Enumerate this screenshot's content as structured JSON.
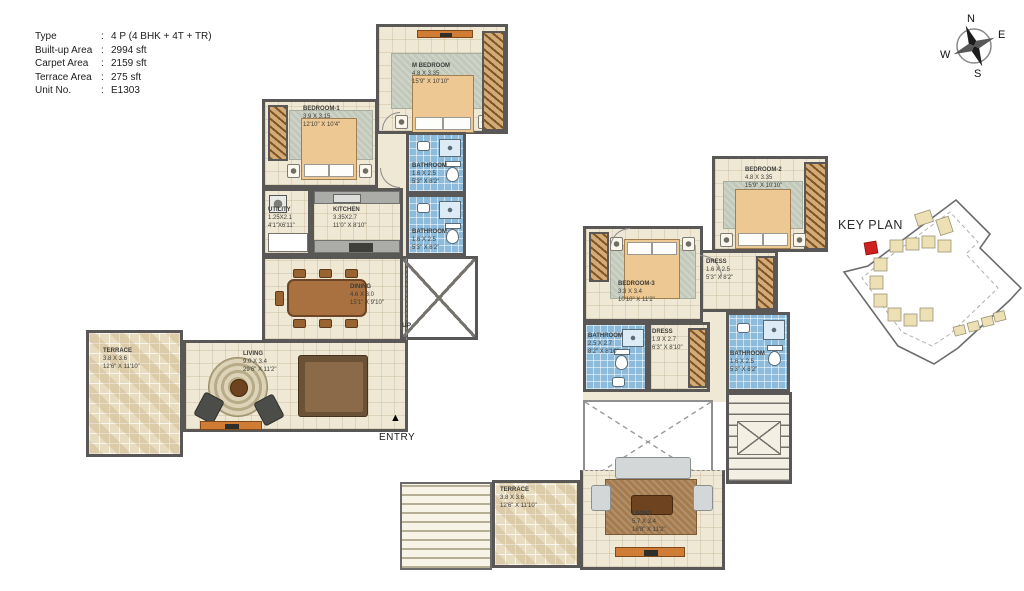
{
  "info_panel": {
    "separator": ":",
    "rows": [
      {
        "label": "Type",
        "value": "4 P (4 BHK + 4T + TR)"
      },
      {
        "label": "Built-up Area",
        "value": "2994 sft"
      },
      {
        "label": "Carpet Area",
        "value": "2159 sft"
      },
      {
        "label": "Terrace Area",
        "value": "275 sft"
      },
      {
        "label": "Unit No.",
        "value": "E1303"
      }
    ]
  },
  "compass": {
    "n": "N",
    "e": "E",
    "s": "S",
    "w": "W"
  },
  "key_plan": {
    "title": "KEY PLAN",
    "highlight_color": "#cf1f1f"
  },
  "lower_plan": {
    "up_label": "UP",
    "entry_label": "ENTRY",
    "entry_arrow": "▲",
    "rooms": [
      {
        "name": "M BEDROOM",
        "dim_m": "4.8 X 3.35",
        "dim_ft": "15'9\" X 10'10\""
      },
      {
        "name": "BEDROOM-1",
        "dim_m": "3.9 X 3.15",
        "dim_ft": "12'10\" X 10'4\""
      },
      {
        "name": "BATHROOM",
        "dim_m": "1.6 X 2.5",
        "dim_ft": "5'3\" X 8'2\""
      },
      {
        "name": "BATHROOM",
        "dim_m": "1.6 X 2.5",
        "dim_ft": "5'3\" X 8'2\""
      },
      {
        "name": "UTILITY",
        "dim_m": "1.25X2.1",
        "dim_ft": "4'1\"X6'11\""
      },
      {
        "name": "KITCHEN",
        "dim_m": "3.35X2.7",
        "dim_ft": "11'0\" X 8'10\""
      },
      {
        "name": "DINING",
        "dim_m": "4.6 X 3.0",
        "dim_ft": "15'1\" X 9'10\""
      },
      {
        "name": "TERRACE",
        "dim_m": "3.8 X 3.6",
        "dim_ft": "12'6\" X 11'10\""
      },
      {
        "name": "LIVING",
        "dim_m": "9.0 X 3.4",
        "dim_ft": "29'6\" X 11'2\""
      }
    ]
  },
  "upper_plan": {
    "rooms": [
      {
        "name": "BEDROOM-2",
        "dim_m": "4.8 X 3.35",
        "dim_ft": "15'9\" X 10'10\""
      },
      {
        "name": "DRESS",
        "dim_m": "1.6 X 2.5",
        "dim_ft": "5'3\" X 8'2\""
      },
      {
        "name": "BATHROOM",
        "dim_m": "1.6 X 2.5",
        "dim_ft": "5'3\" X 8'2\""
      },
      {
        "name": "BEDROOM-3",
        "dim_m": "3.3 X 3.4",
        "dim_ft": "10'10\" X 11'2\""
      },
      {
        "name": "BATHROOM",
        "dim_m": "2.5 X 2.7",
        "dim_ft": "8'2\" X 8'10\""
      },
      {
        "name": "DRESS",
        "dim_m": "1.9 X 2.7",
        "dim_ft": "6'3\" X 8'10\""
      },
      {
        "name": "TERRACE",
        "dim_m": "3.8 X 3.6",
        "dim_ft": "12'6\" X 11'10\""
      },
      {
        "name": "LIVING",
        "dim_m": "5.7 X 3.4",
        "dim_ft": "18'8\" X 11'2\""
      }
    ]
  },
  "colors": {
    "wall": "#5a5856",
    "floor": "#efe8d5",
    "bath_tile": "#8cbbdb",
    "wardrobe": "#d2ab77",
    "terrace": "#e8dcc0",
    "accent_red": "#cf1f1f",
    "console_orange": "#d07c35"
  }
}
